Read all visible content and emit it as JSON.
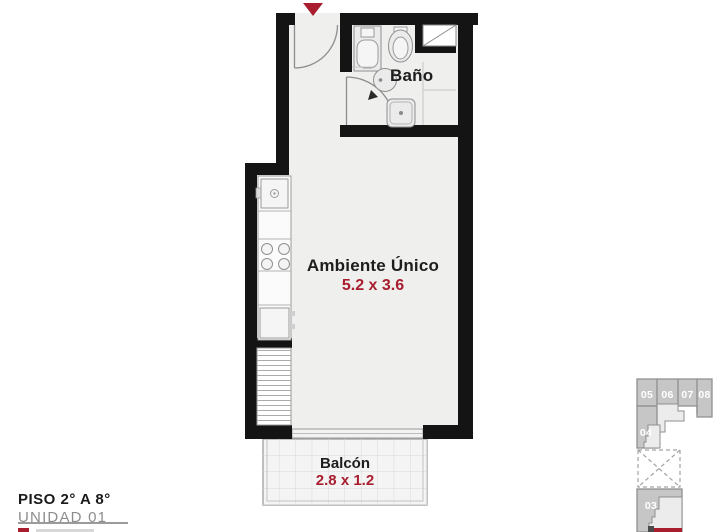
{
  "colors": {
    "accent": "#a81e2f",
    "wall": "#141414",
    "room-fill": "#efefee",
    "keyplan-fill": "#c6c6c6",
    "keyplan-stroke": "#8f8f8f",
    "keyplan-light": "#ececec",
    "label": "#1d1d1d",
    "muted": "#8d8d8d"
  },
  "plan": {
    "rooms": {
      "bathroom": {
        "label": "Baño"
      },
      "main": {
        "label": "Ambiente Único",
        "dimensions": "5.2 x 3.6"
      },
      "balcony": {
        "label": "Balcón",
        "dimensions": "2.8 x 1.2"
      }
    }
  },
  "footer": {
    "floor": "PISO 2° A 8°",
    "unit": "UNIDAD 01"
  },
  "keyplan": {
    "units": [
      {
        "label": "05"
      },
      {
        "label": "06"
      },
      {
        "label": "07"
      },
      {
        "label": "08"
      },
      {
        "label": "04"
      },
      {
        "label": "03"
      }
    ]
  }
}
